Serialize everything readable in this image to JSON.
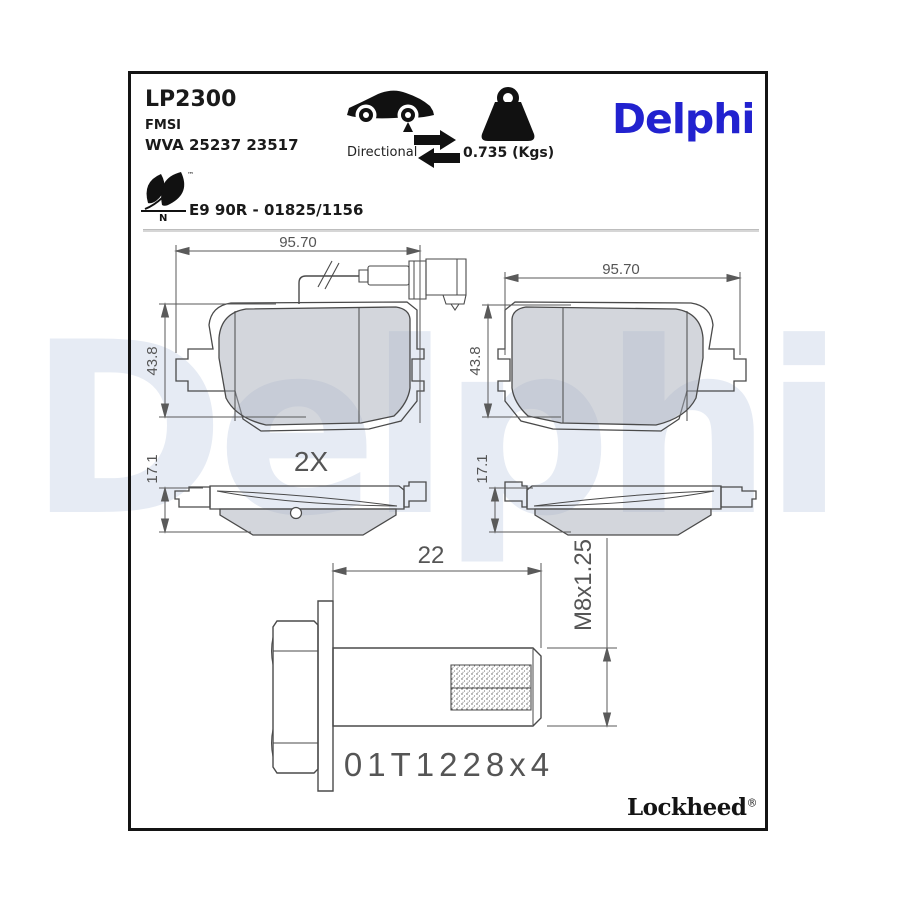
{
  "header": {
    "part_number": "LP2300",
    "fmsi_label": "FMSI",
    "wva_numbers": "WVA 25237 23517",
    "directional_label": "Directional",
    "weight_value": "0.735 (Kgs)",
    "brand_logo": "Delphi",
    "eco": {
      "letter": "N",
      "trademark": "™"
    },
    "approval_number": "E9 90R - 01825/1156"
  },
  "drawings": {
    "pad_front_left": {
      "width_dim": "95.70",
      "height_dim": "43.8"
    },
    "pad_front_right": {
      "width_dim": "95.70",
      "height_dim": "43.8"
    },
    "quantity_label": "2X",
    "profile_left": {
      "thickness_dim": "17.1"
    },
    "profile_right": {
      "thickness_dim": "17.1"
    },
    "bolt": {
      "length_dim": "22",
      "thread_spec": "M8x1.25",
      "part_ref": "01T1228x4"
    }
  },
  "footer": {
    "brand": "Lockheed",
    "registered_mark": "®"
  },
  "watermark_text": "Delphi",
  "colors": {
    "brand_blue": "#2222cf",
    "watermark": "#e6ebf4",
    "drawing_line": "#4a4a4a",
    "dimension_text": "#555555",
    "pad_fill": "#b9bdc9"
  }
}
